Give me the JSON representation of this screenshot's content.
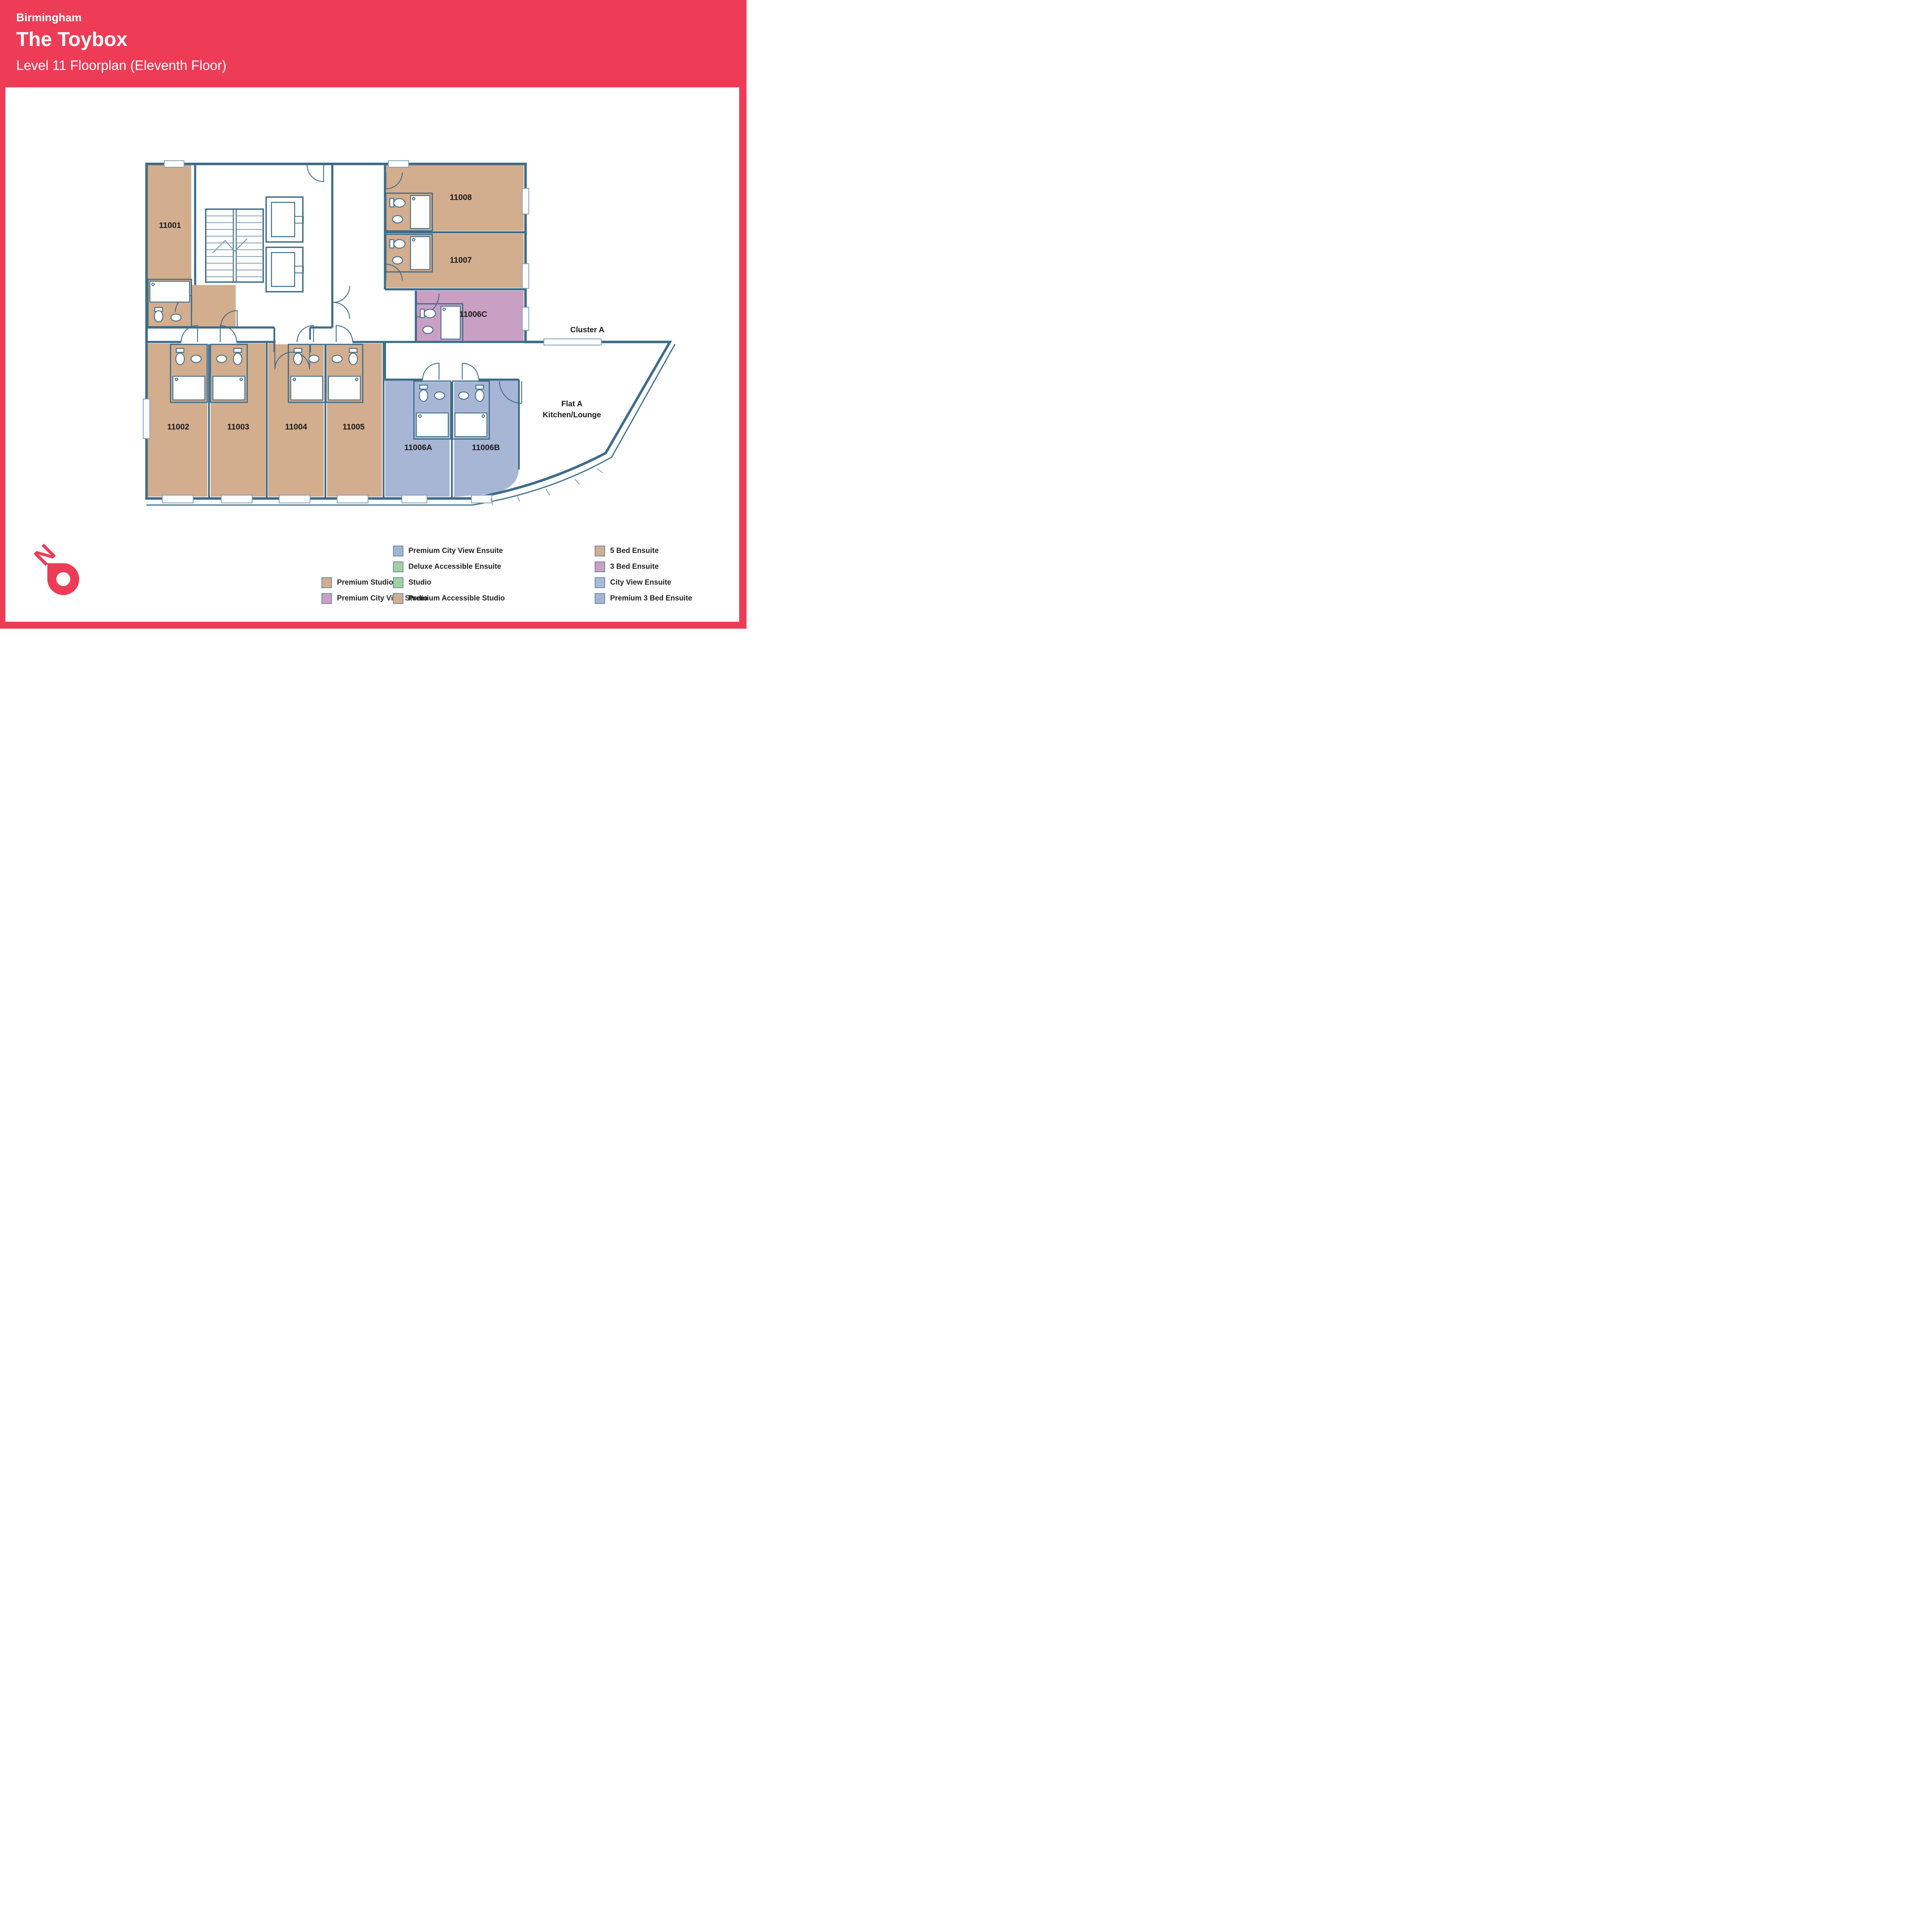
{
  "header": {
    "city": "Birmingham",
    "building": "The Toybox",
    "subtitle": "Level 11 Floorplan (Eleventh Floor)"
  },
  "theme": {
    "accent_red": "#ee3c56",
    "wall": "#3e6c88",
    "tan": "#d2ad8e",
    "pink": "#c9a0c4",
    "blue": "#a8b6d5",
    "label": "#1c1c1c"
  },
  "floorplan": {
    "compass_letter": "N",
    "annotations": {
      "cluster": "Cluster A",
      "flat_line1": "Flat A",
      "flat_line2": "Kitchen/Lounge"
    },
    "rooms": [
      {
        "label": "11001",
        "fill": "#d2ad8e"
      },
      {
        "label": "11002",
        "fill": "#d2ad8e"
      },
      {
        "label": "11003",
        "fill": "#d2ad8e"
      },
      {
        "label": "11004",
        "fill": "#d2ad8e"
      },
      {
        "label": "11005",
        "fill": "#d2ad8e"
      },
      {
        "label": "11006A",
        "fill": "#a8b6d5"
      },
      {
        "label": "11006B",
        "fill": "#a8b6d5"
      },
      {
        "label": "11006C",
        "fill": "#c9a0c4"
      },
      {
        "label": "11007",
        "fill": "#d2ad8e"
      },
      {
        "label": "11008",
        "fill": "#d2ad8e"
      }
    ]
  },
  "legend": {
    "columns": [
      [
        {
          "label": "Premium Studio",
          "color": "#d2ad8e"
        },
        {
          "label": "Premium City View Studio",
          "color": "#c9a0c4"
        }
      ],
      [
        {
          "label": "Premium City View Ensuite",
          "color": "#a2b5d7"
        },
        {
          "label": "Deluxe Accessible Ensuite",
          "color": "#a4cfa1"
        },
        {
          "label": "Studio",
          "color": "#9cd49a"
        },
        {
          "label": "Premium Accessible Studio",
          "color": "#d2ad8e"
        }
      ],
      [
        {
          "label": "5 Bed Ensuite",
          "color": "#d2ad8e"
        },
        {
          "label": "3 Bed Ensuite",
          "color": "#c9a0c4"
        },
        {
          "label": "City View Ensuite",
          "color": "#a7bad8"
        },
        {
          "label": "Premium 3 Bed Ensuite",
          "color": "#a3b3d6"
        }
      ]
    ]
  }
}
